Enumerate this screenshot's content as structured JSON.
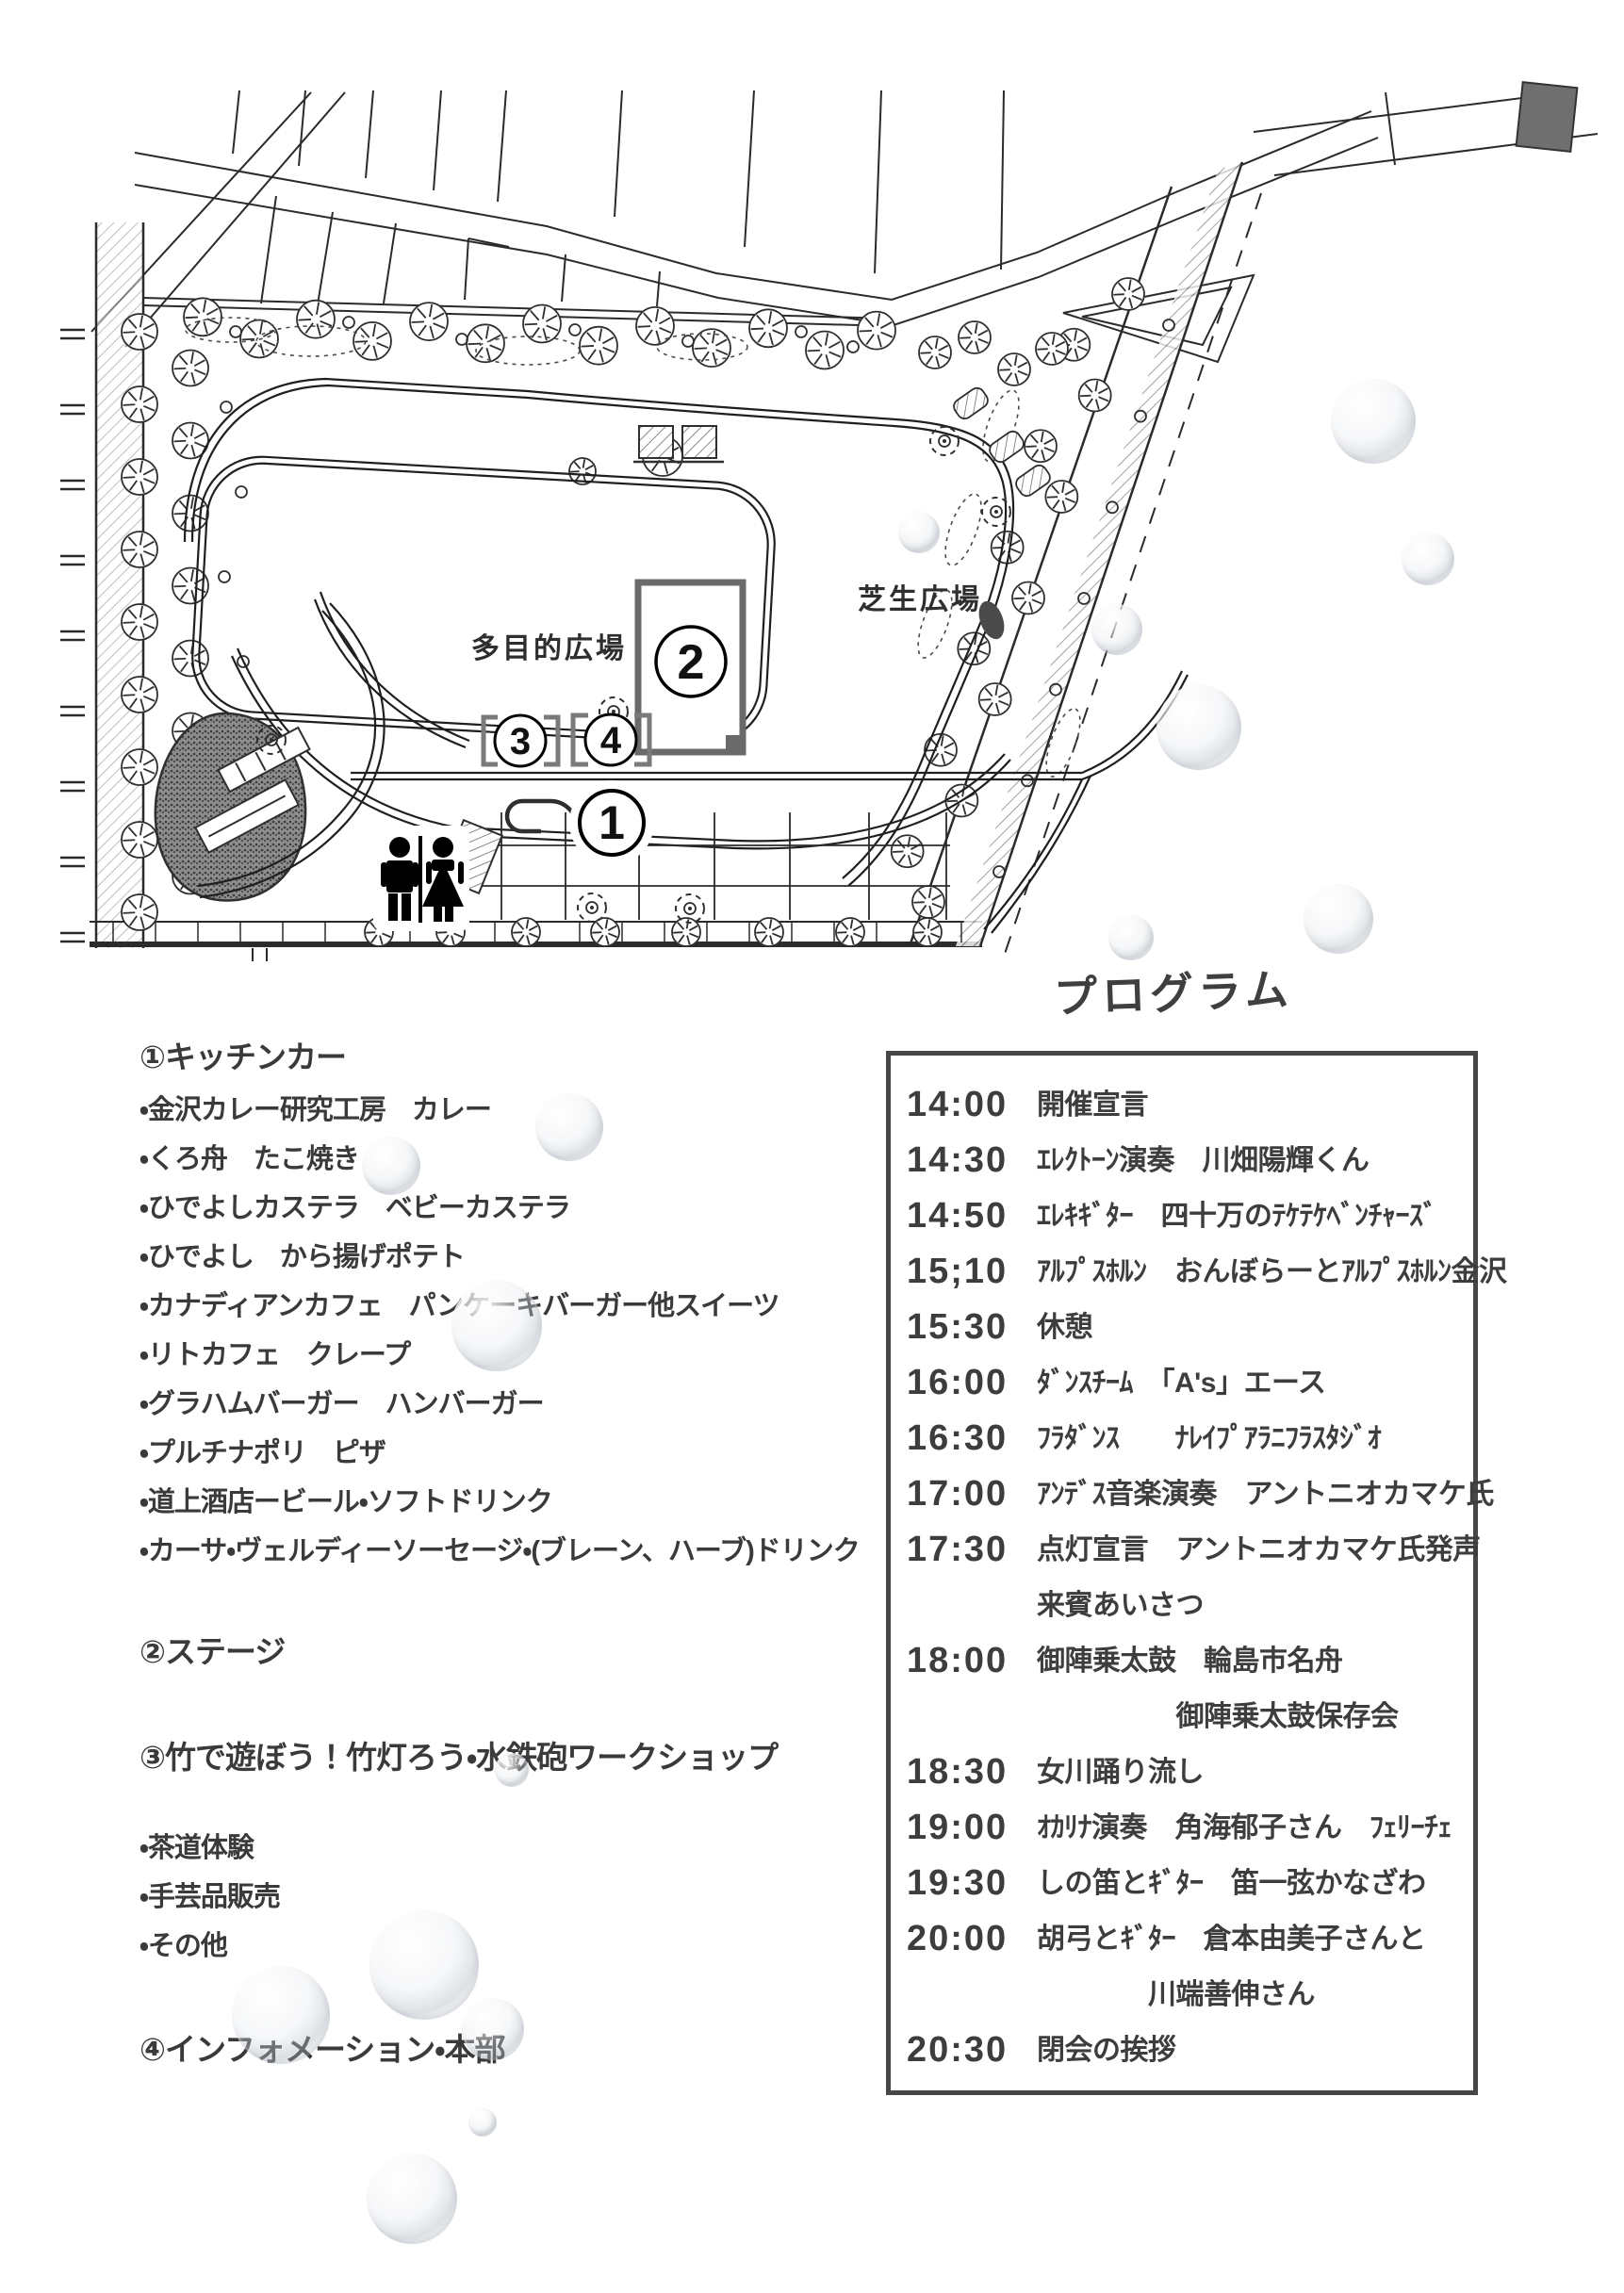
{
  "colors": {
    "ink": "#3a3a3a",
    "map_line": "#2b2b2b",
    "program_border": "#474747",
    "stage_border": "#6a6a6a",
    "bracket_gray": "#7a7a7a"
  },
  "map": {
    "multi_purpose_plaza_label": "多目的広場",
    "lawn_plaza_label": "芝生広場",
    "markers": {
      "m1": "1",
      "m2": "2",
      "m3": "3",
      "m4": "4"
    }
  },
  "legend": {
    "s1": {
      "heading": "①キッチンカー",
      "items": [
        "・金沢カレー研究工房　カレー",
        "・くろ舟　たこ焼き",
        "・ひでよしカステラ　ベビーカステラ",
        "・ひでよし　から揚げポテト",
        "・カナディアンカフェ　パンケーキバーガー他スイーツ",
        "・リトカフェ　クレープ",
        "・グラハムバーガー　ハンバーガー",
        "・プルチナポリ　ピザ",
        "・道上酒店ービール・ソフトドリンク",
        "・カーサ・ヴェルディーソーセージ・(ブレーン、ハーブ)ドリンク"
      ]
    },
    "s2": {
      "heading": "②ステージ"
    },
    "s3": {
      "heading": "③竹で遊ぼう！竹灯ろう・水鉄砲ワークショップ",
      "items": [
        "・茶道体験",
        "・手芸品販売",
        "・その他"
      ]
    },
    "s4": {
      "heading": "④インフォメーション・本部"
    }
  },
  "program": {
    "title": "プログラム",
    "rows": [
      {
        "time": "14:00",
        "text": "開催宣言"
      },
      {
        "time": "14:30",
        "text": "ｴﾚｸﾄｰﾝ演奏　川畑陽輝くん"
      },
      {
        "time": "14:50",
        "text": "ｴﾚｷｷﾞﾀｰ　四十万のﾃｹﾃｹﾍﾞﾝﾁｬｰｽﾞ"
      },
      {
        "time": "15;10",
        "text": "ｱﾙﾌﾟｽﾎﾙﾝ　おんぼらーとｱﾙﾌﾟｽﾎﾙﾝ金沢"
      },
      {
        "time": "15:30",
        "text": "休憩"
      },
      {
        "time": "16:00",
        "text": "ﾀﾞﾝｽﾁｰﾑ　「A's」エース"
      },
      {
        "time": "16:30",
        "text": "ﾌﾗﾀﾞﾝｽ　　ﾅﾚｲﾌﾟｱﾗﾆﾌﾗｽﾀｼﾞｵ"
      },
      {
        "time": "17:00",
        "text": "ｱﾝﾃﾞｽ音楽演奏　アントニオカマケ氏"
      },
      {
        "time": "17:30",
        "text": "点灯宣言　アントニオカマケ氏発声"
      },
      {
        "time": "",
        "text": "来賓あいさつ"
      },
      {
        "time": "18:00",
        "text": "御陣乗太鼓　輪島市名舟"
      },
      {
        "time": "",
        "text": "　　　　　御陣乗太鼓保存会"
      },
      {
        "time": "18:30",
        "text": "女川踊り流し"
      },
      {
        "time": "19:00",
        "text": "ｵｶﾘﾅ演奏　角海郁子さん　ﾌｪﾘｰﾁｪ"
      },
      {
        "time": "19:30",
        "text": "しの笛とｷﾞﾀｰ　笛一弦かなざわ"
      },
      {
        "time": "20:00",
        "text": "胡弓とｷﾞﾀｰ　倉本由美子さんと"
      },
      {
        "time": "",
        "text": "　　　　川端善伸さん"
      },
      {
        "time": "20:30",
        "text": "閉会の挨拶"
      }
    ]
  }
}
